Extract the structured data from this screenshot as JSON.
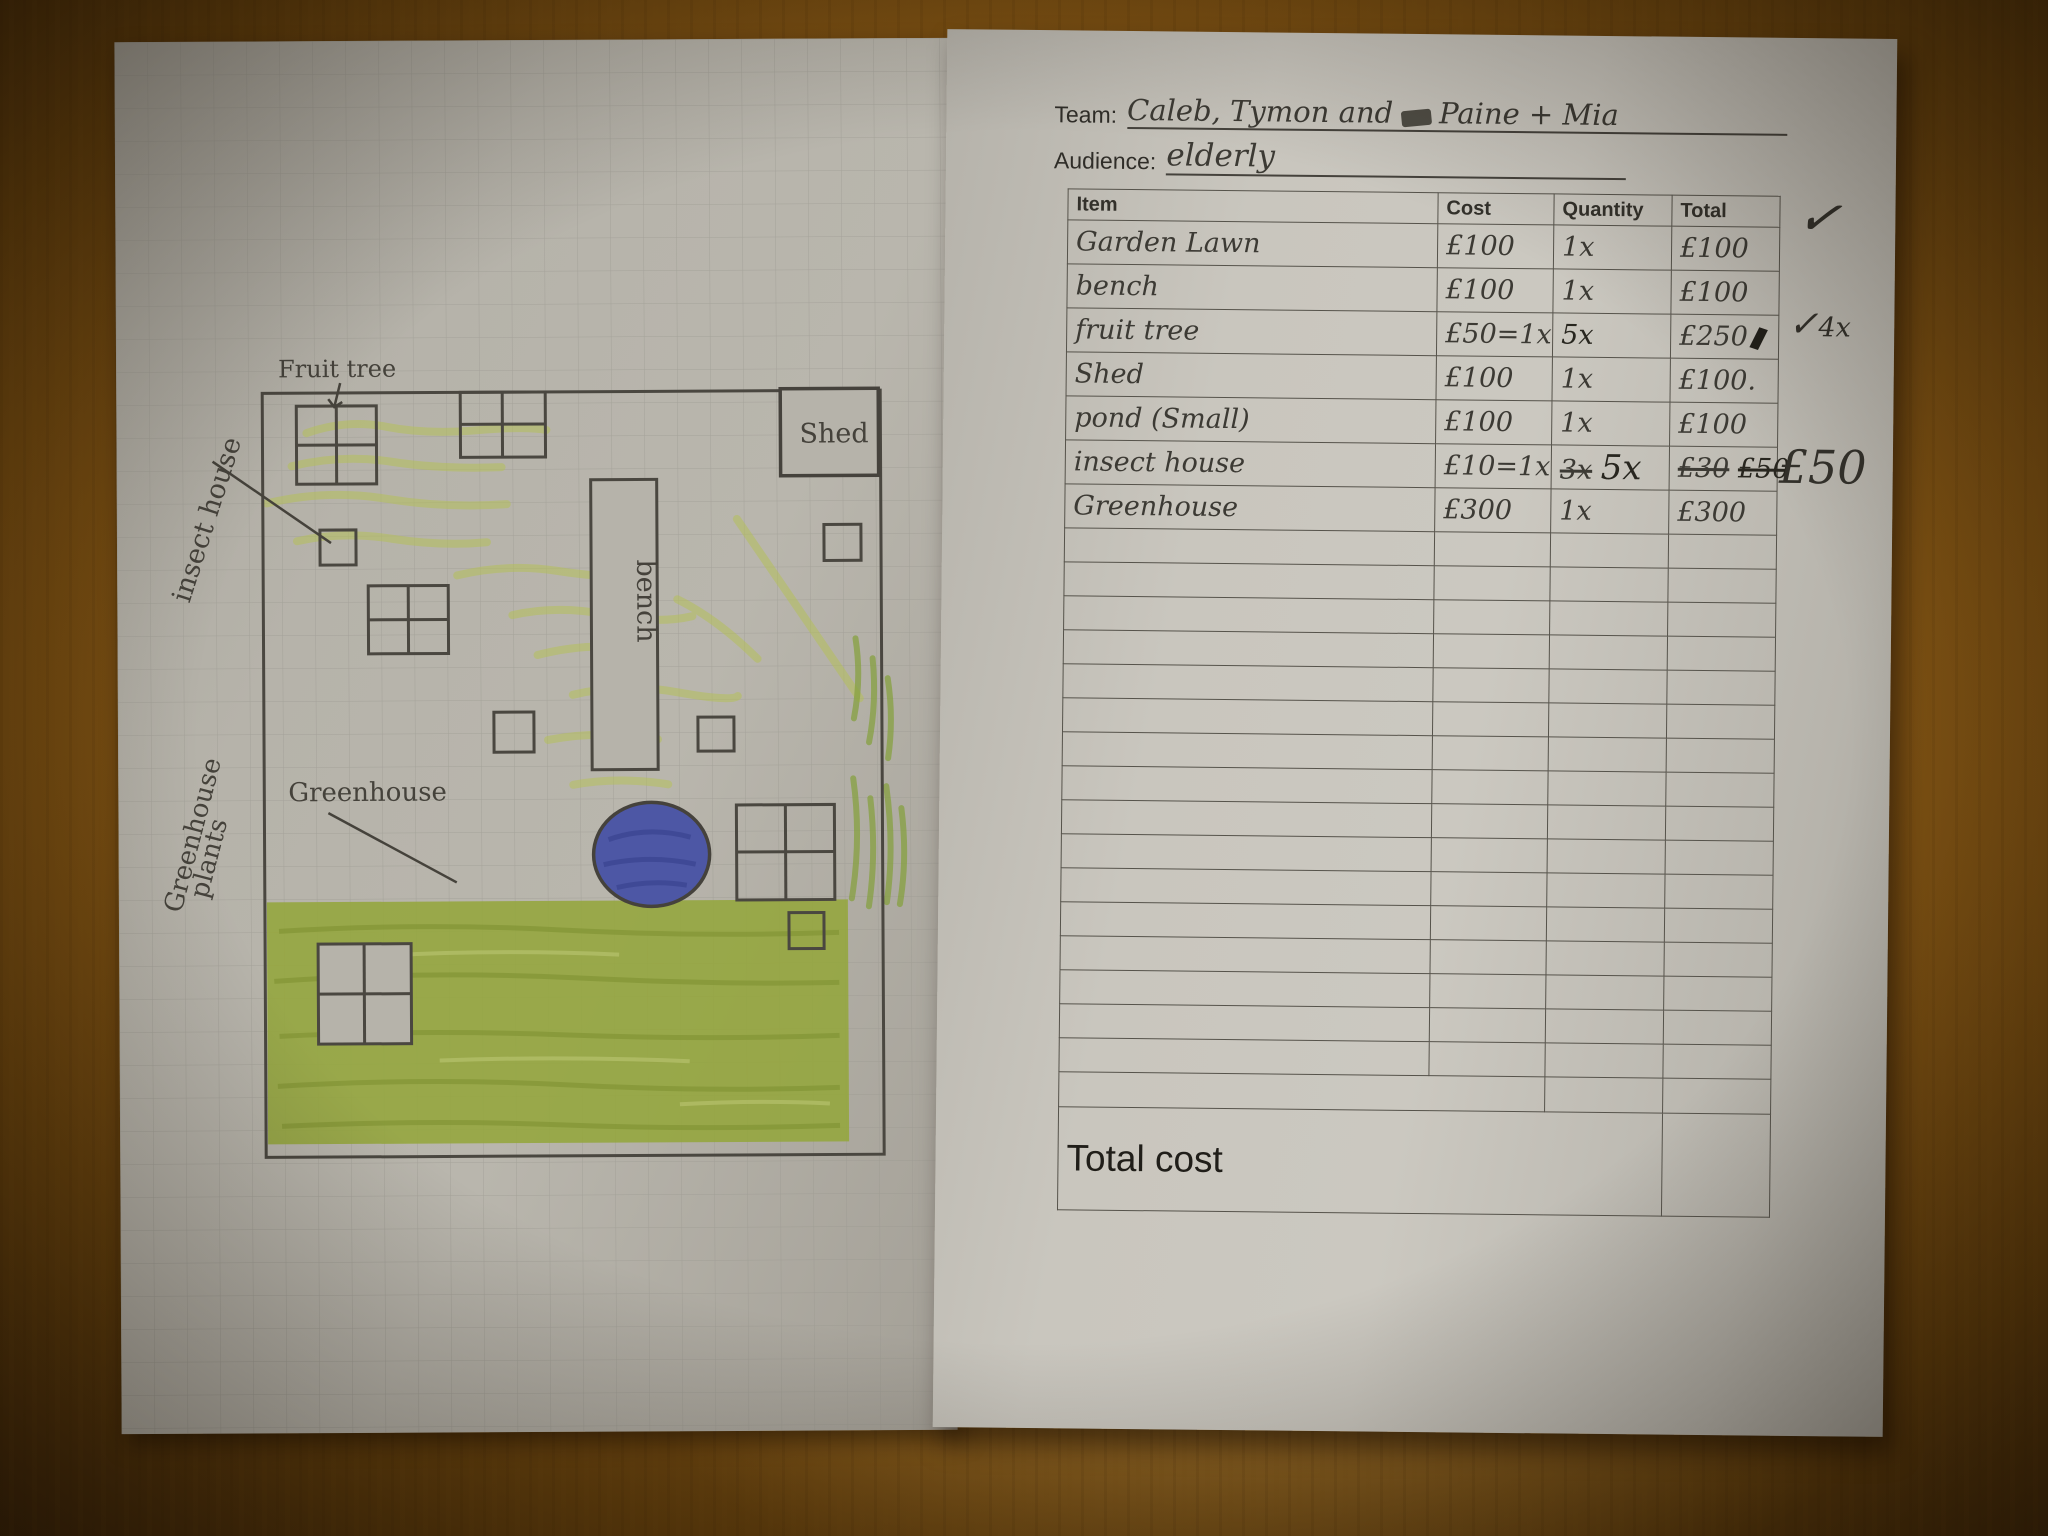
{
  "left_page": {
    "labels": {
      "fruit_tree": "Fruit tree",
      "insect_house": "insect house",
      "shed": "Shed",
      "bench": "bench",
      "greenhouse_plants_line1": "Greenhouse",
      "greenhouse_plants_line2": "plants",
      "greenhouse": "Greenhouse"
    },
    "colors": {
      "paper": "#b6b3aa",
      "grid": "#98968e",
      "pencil": "#4a4740",
      "lawn_green": "#94a63c",
      "light_green": "#b5c153",
      "pond_blue": "#4d57a5"
    }
  },
  "right_page": {
    "team_label": "Team:",
    "team_value_a": "Caleb, Tymon and",
    "team_value_b": "Paine + Mia",
    "audience_label": "Audience:",
    "audience_value": "elderly",
    "table": {
      "headers": [
        "Item",
        "Cost",
        "Quantity",
        "Total"
      ],
      "rows": [
        {
          "item": "Garden Lawn",
          "cost": "£100",
          "quantity": "1x",
          "total": "£100"
        },
        {
          "item": "bench",
          "cost": "£100",
          "quantity": "1x",
          "total": "£100"
        },
        {
          "item": "fruit tree",
          "cost": "£50=1x",
          "quantity": "5x",
          "total": "£250"
        },
        {
          "item": "Shed",
          "cost": "£100",
          "quantity": "1x",
          "total": "£100."
        },
        {
          "item": "pond (Small)",
          "cost": "£100",
          "quantity": "1x",
          "total": "£100"
        },
        {
          "item": "insect house",
          "cost": "£10=1x",
          "quantity_struck": "3x",
          "quantity": "5x",
          "total_struck_a": "£30",
          "total_struck_b": "£50"
        },
        {
          "item": "Greenhouse",
          "cost": "£300",
          "quantity": "1x",
          "total": "£300"
        }
      ],
      "empty_row_count": 16,
      "total_row_label": "Total cost"
    },
    "margin_notes": {
      "row1_check": "✓",
      "row3_check": "✓",
      "row3_note": "4x",
      "row6_price": "£50"
    },
    "colors": {
      "paper": "#c9c6be",
      "ink": "#2f2d28",
      "table_line": "#56534b"
    }
  },
  "background": {
    "desk_color": "#8a5a16"
  }
}
